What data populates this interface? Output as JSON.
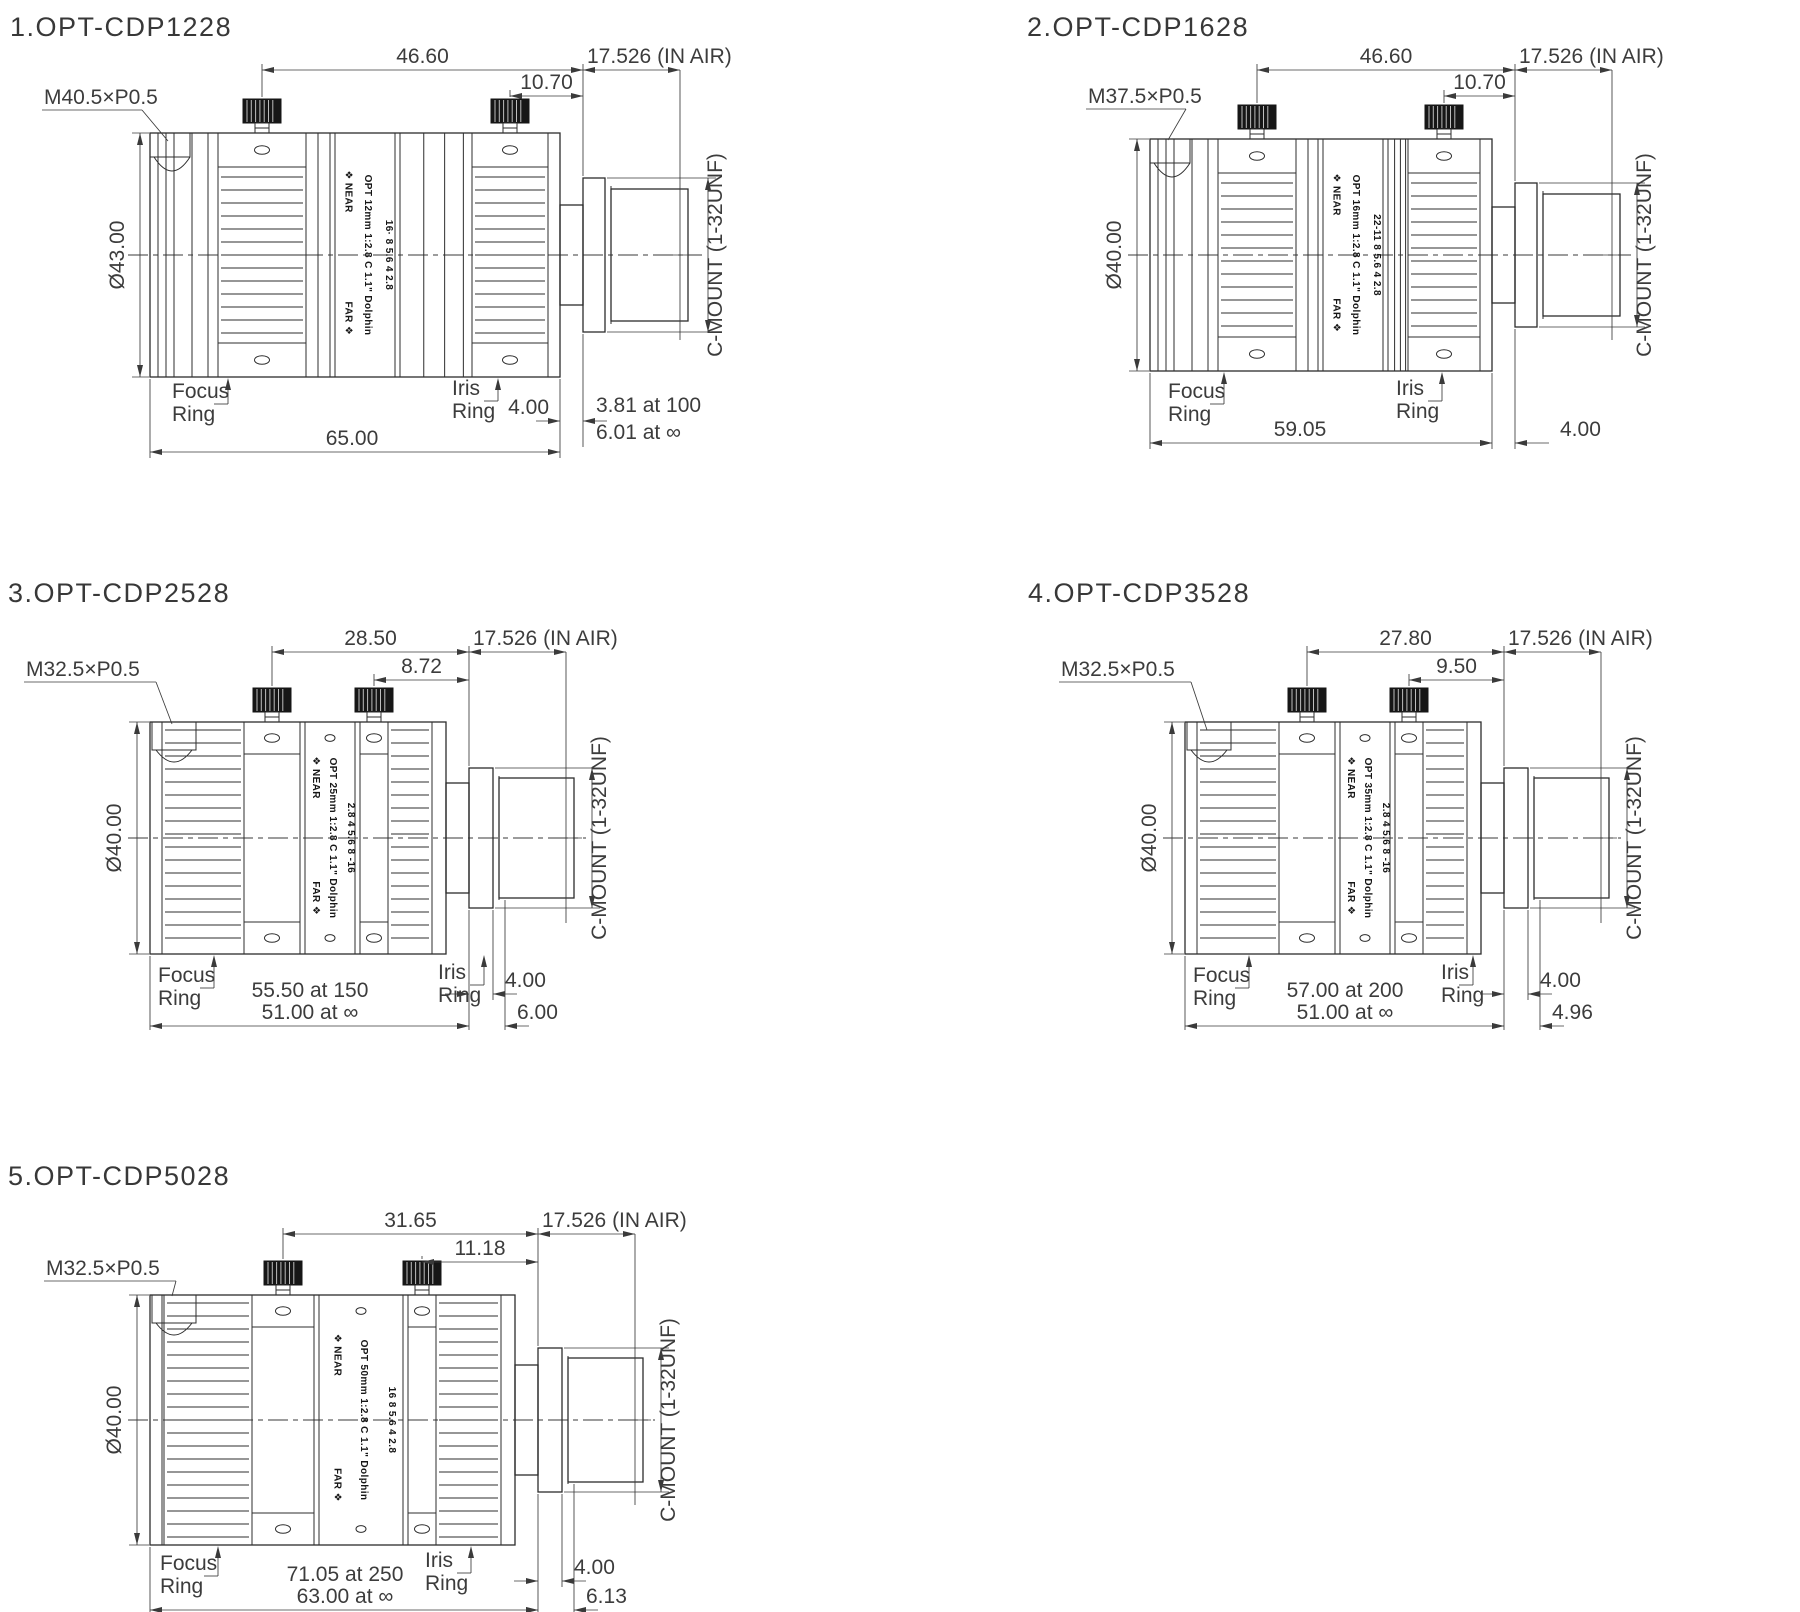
{
  "sheet": {
    "background": "#ffffff",
    "line_color": "#2d2d2d",
    "text_color": "#3c3c3c"
  },
  "lenses": [
    {
      "title": "1.OPT-CDP1228",
      "thread_label": "M40.5×P0.5",
      "diameter_label": "Ø43.00",
      "dims": {
        "top_main": "46.60",
        "top_small": "10.70",
        "in_air": "17.526 (IN AIR)",
        "flange": "4.00"
      },
      "bottom": {
        "length": "65.00",
        "bfd_line1": "3.81 at 100",
        "bfd_line2": "6.01 at ∞"
      },
      "labels": {
        "focus_line1": "Focus",
        "focus_line2": "Ring",
        "iris_line1": "Iris",
        "iris_line2": "Ring",
        "cmount": "C-MOUNT (1-32UNF)"
      },
      "barrel": {
        "near": "❖ NEAR",
        "far": "FAR ❖",
        "model": "OPT 12mm 1:2.8 C 1.1\" Dolphin",
        "apertures": "16· 8  5.6   4    2.8"
      }
    },
    {
      "title": "2.OPT-CDP1628",
      "thread_label": "M37.5×P0.5",
      "diameter_label": "Ø40.00",
      "dims": {
        "top_main": "46.60",
        "top_small": "10.70",
        "in_air": "17.526 (IN AIR)",
        "flange": "4.00"
      },
      "bottom": {
        "length": "59.05"
      },
      "labels": {
        "focus_line1": "Focus",
        "focus_line2": "Ring",
        "iris_line1": "Iris",
        "iris_line2": "Ring",
        "cmount": "C-MOUNT (1-32UNF)"
      },
      "barrel": {
        "near": "❖ NEAR",
        "far": "FAR ❖",
        "model": "OPT 16mm 1:2.8 C 1.1\" Dolphin",
        "apertures": "22-11 8  5.6   4    2.8"
      }
    },
    {
      "title": "3.OPT-CDP2528",
      "thread_label": "M32.5×P0.5",
      "diameter_label": "Ø40.00",
      "dims": {
        "top_main": "28.50",
        "top_small": "8.72",
        "in_air": "17.526 (IN AIR)",
        "flange": "4.00"
      },
      "bottom": {
        "length_line1": "55.50 at 150",
        "length_line2": "51.00 at ∞",
        "right_dim2": "6.00"
      },
      "labels": {
        "focus_line1": "Focus",
        "focus_line2": "Ring",
        "iris_line1": "Iris",
        "iris_line2": "Ring",
        "cmount": "C-MOUNT (1-32UNF)"
      },
      "barrel": {
        "near": "❖ NEAR",
        "far": "FAR ❖",
        "model": "OPT 25mm 1:2.8 C 1.1\" Dolphin",
        "apertures": "2.8   4   5.6  8  -16"
      }
    },
    {
      "title": "4.OPT-CDP3528",
      "thread_label": "M32.5×P0.5",
      "diameter_label": "Ø40.00",
      "dims": {
        "top_main": "27.80",
        "top_small": "9.50",
        "in_air": "17.526 (IN AIR)",
        "flange": "4.00"
      },
      "bottom": {
        "length_line1": "57.00 at 200",
        "length_line2": "51.00 at ∞",
        "right_dim2": "4.96"
      },
      "labels": {
        "focus_line1": "Focus",
        "focus_line2": "Ring",
        "iris_line1": "Iris",
        "iris_line2": "Ring",
        "cmount": "C-MOUNT (1-32UNF)"
      },
      "barrel": {
        "near": "❖ NEAR",
        "far": "FAR ❖",
        "model": "OPT 35mm 1:2.8 C 1.1\" Dolphin",
        "apertures": "2.8   4   5.6  8  -16"
      }
    },
    {
      "title": "5.OPT-CDP5028",
      "thread_label": "M32.5×P0.5",
      "diameter_label": "Ø40.00",
      "dims": {
        "top_main": "31.65",
        "top_small": "11.18",
        "in_air": "17.526 (IN AIR)",
        "flange": "4.00"
      },
      "bottom": {
        "length_line1": "71.05 at 250",
        "length_line2": "63.00 at ∞",
        "right_dim2": "6.13"
      },
      "labels": {
        "focus_line1": "Focus",
        "focus_line2": "Ring",
        "iris_line1": "Iris",
        "iris_line2": "Ring",
        "cmount": "C-MOUNT (1-32UNF)"
      },
      "barrel": {
        "near": "❖ NEAR",
        "far": "FAR ❖",
        "model": "OPT 50mm 1:2.8 C 1.1\" Dolphin",
        "apertures": "16  8  5.6    4     2.8"
      }
    }
  ]
}
